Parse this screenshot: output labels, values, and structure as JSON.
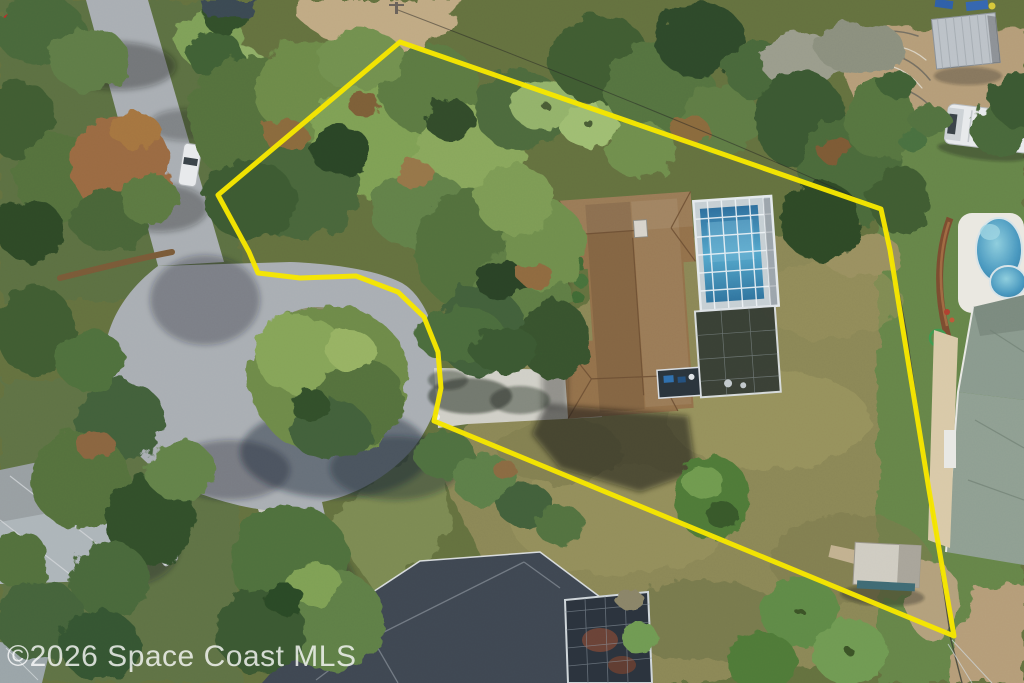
{
  "watermark": {
    "text": "©2026 Space Coast MLS"
  },
  "palette": {
    "boundary_yellow": "#f6e600",
    "road_gray": "#a9aeb3",
    "driveway_concrete": "#d0cfc7",
    "main_roof_brown": "#93714b",
    "pool_blue": "#3f8fba",
    "neighbor_pool_blue": "#4796be",
    "dark_roof_gray": "#3f4752",
    "light_roof_gray": "#adb5b9",
    "neighbor_roof_sage": "#8a9a8e",
    "lawn_olive": "#8b8757",
    "neighbor_lawn_green": "#66854a",
    "sand_tan": "#b59d79",
    "watermark_white": "rgba(255,255,255,0.78)"
  },
  "property_boundary": {
    "stroke_width": 5,
    "points": [
      [
        400,
        42
      ],
      [
        218,
        195
      ],
      [
        249,
        252
      ],
      [
        258,
        273
      ],
      [
        300,
        278
      ],
      [
        356,
        276
      ],
      [
        398,
        292
      ],
      [
        424,
        317
      ],
      [
        438,
        352
      ],
      [
        441,
        388
      ],
      [
        434,
        421
      ],
      [
        954,
        636
      ],
      [
        929,
        490
      ],
      [
        890,
        250
      ],
      [
        881,
        209
      ]
    ]
  }
}
